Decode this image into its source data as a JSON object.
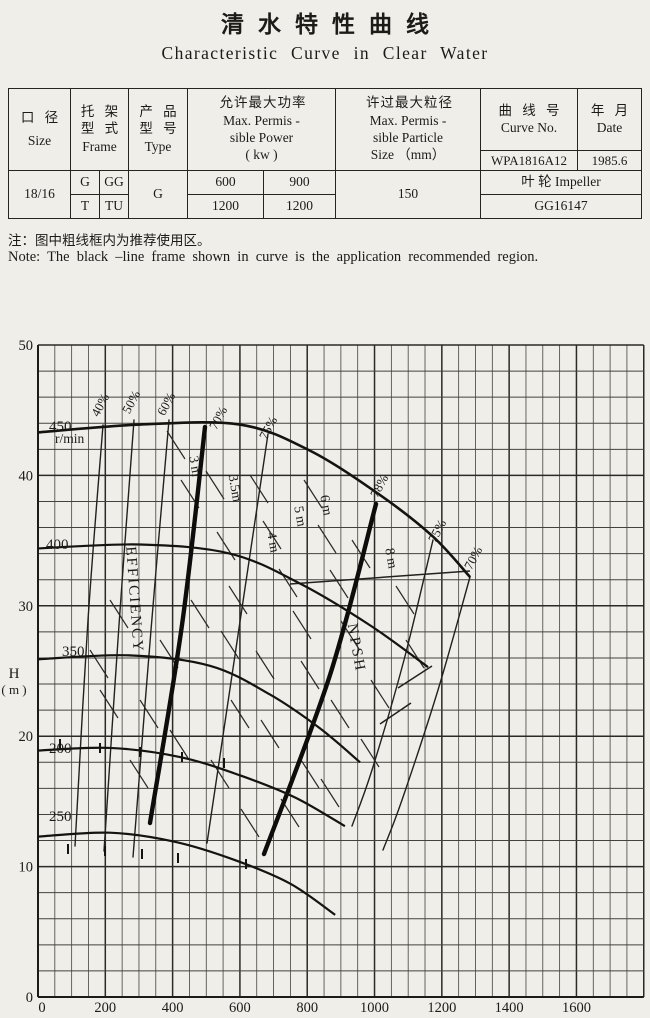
{
  "page": {
    "title_cn": "清水特性曲线",
    "title_en": "Characteristic Curve in Clear Water",
    "note_cn": "注：图中粗线框内为推荐使用区。",
    "note_en": "Note: The black –line frame shown in curve is the application recommended region."
  },
  "table": {
    "headers": {
      "size_cn": "口 径",
      "size_en": "Size",
      "frame_cn1": "托 架",
      "frame_cn2": "型 式",
      "frame_en": "Frame",
      "type_cn1": "产 品",
      "type_cn2": "型 号",
      "type_en": "Type",
      "power_cn": "允许最大功率",
      "power_en1": "Max. Permis -",
      "power_en2": "sible Power",
      "power_en3": "( kw )",
      "particle_cn": "许过最大粒径",
      "particle_en1": "Max. Permis -",
      "particle_en2": "sible Particle",
      "particle_en3": "Size （mm）",
      "curve_cn": "曲 线 号",
      "curve_en": "Curve No.",
      "date_cn": "年 月",
      "date_en": "Date"
    },
    "values": {
      "size": "18/16",
      "frame_g": "G",
      "frame_gg": "GG",
      "frame_t": "T",
      "frame_tu": "TU",
      "type": "G",
      "power_1": "600",
      "power_2": "900",
      "power_3": "1200",
      "power_4": "1200",
      "particle": "150",
      "curve_no": "WPA1816A12",
      "date": "1985.6",
      "impeller_label": "叶 轮 Impeller",
      "impeller_no": "GG16147"
    }
  },
  "chart_data": {
    "type": "line",
    "title": "Pump head vs flow characteristic curves at several speeds (r/min), with iso-efficiency and NPSH contours",
    "xlabel": "Q",
    "ylabel": "H (m)",
    "xlim": [
      0,
      1800
    ],
    "ylim": [
      0,
      50
    ],
    "x_ticks": [
      0,
      200,
      400,
      600,
      800,
      1000,
      1200,
      1400,
      1600
    ],
    "y_ticks": [
      0,
      10,
      20,
      30,
      40,
      50
    ],
    "grid": {
      "x_minor_step": 50,
      "x_major_step": 200,
      "y_step": 2,
      "y_major_step": 10,
      "on": true
    },
    "legend_position": "none",
    "series": [
      {
        "name": "450",
        "sublabel": "r/min",
        "points": [
          [
            0,
            43.3
          ],
          [
            303,
            43.9
          ],
          [
            600,
            43.9
          ],
          [
            808,
            41.9
          ],
          [
            1016,
            38.5
          ],
          [
            1174,
            35.3
          ],
          [
            1284,
            32.2
          ]
        ]
      },
      {
        "name": "400",
        "sublabel": "",
        "points": [
          [
            0,
            34.4
          ],
          [
            303,
            34.7
          ],
          [
            571,
            34.0
          ],
          [
            779,
            31.7
          ],
          [
            987,
            28.5
          ],
          [
            1159,
            25.3
          ]
        ]
      },
      {
        "name": "350",
        "sublabel": "",
        "points": [
          [
            0,
            25.9
          ],
          [
            273,
            26.2
          ],
          [
            511,
            25.4
          ],
          [
            689,
            23.2
          ],
          [
            838,
            20.6
          ],
          [
            957,
            18.0
          ]
        ]
      },
      {
        "name": "200",
        "sublabel": "",
        "points": [
          [
            0,
            18.9
          ],
          [
            214,
            19.1
          ],
          [
            422,
            18.4
          ],
          [
            600,
            17.0
          ],
          [
            764,
            15.3
          ],
          [
            912,
            13.1
          ]
        ]
      },
      {
        "name": "250",
        "sublabel": "",
        "points": [
          [
            0,
            12.3
          ],
          [
            214,
            12.6
          ],
          [
            407,
            11.9
          ],
          [
            585,
            10.5
          ],
          [
            749,
            8.7
          ],
          [
            883,
            6.3
          ]
        ]
      }
    ],
    "efficiency_contours": [
      {
        "label": "40%",
        "thick": false,
        "pts": [
          [
            103,
            425
          ],
          [
            88,
            620
          ],
          [
            75,
            846
          ]
        ],
        "label_px": [
          104,
          407
        ]
      },
      {
        "label": "50%",
        "thick": false,
        "pts": [
          [
            134,
            420
          ],
          [
            119,
            625
          ],
          [
            104,
            851
          ]
        ],
        "label_px": [
          135,
          404
        ]
      },
      {
        "label": "60%",
        "thick": false,
        "pts": [
          [
            169,
            420
          ],
          [
            151,
            630
          ],
          [
            133,
            857
          ]
        ],
        "label_px": [
          170,
          406
        ]
      },
      {
        "label": "70%",
        "thick": true,
        "pts": [
          [
            205,
            427
          ],
          [
            182,
            625
          ],
          [
            150,
            823
          ]
        ],
        "label_px": [
          222,
          420
        ]
      },
      {
        "label": "75%",
        "thick": false,
        "pts": [
          [
            268,
            434
          ],
          [
            238,
            635
          ],
          [
            207,
            843
          ]
        ],
        "label_px": [
          272,
          430
        ]
      },
      {
        "label": "78%",
        "thick": true,
        "pts": [
          [
            376,
            504
          ],
          [
            330,
            675
          ],
          [
            264,
            854
          ]
        ],
        "label_px": [
          383,
          488
        ]
      },
      {
        "label": "75%",
        "thick": false,
        "pts": [
          [
            433,
            540
          ],
          [
            404,
            660
          ],
          [
            372,
            770
          ],
          [
            352,
            826
          ]
        ],
        "label_px": [
          441,
          533
        ]
      },
      {
        "label": "70%",
        "thick": false,
        "pts": [
          [
            470,
            577
          ],
          [
            438,
            690
          ],
          [
            402,
            800
          ],
          [
            383,
            850
          ]
        ],
        "label_px": [
          477,
          560
        ]
      }
    ],
    "npsh_contours": [
      {
        "label": "3 m",
        "label_px": [
          191,
          467
        ]
      },
      {
        "label": "3.5m",
        "label_px": [
          231,
          489
        ]
      },
      {
        "label": "4 m",
        "label_px": [
          269,
          543
        ]
      },
      {
        "label": "5 m",
        "label_px": [
          296,
          517
        ]
      },
      {
        "label": "6 m",
        "label_px": [
          322,
          506
        ]
      },
      {
        "label": "8 m",
        "label_px": [
          387,
          559
        ]
      }
    ],
    "npsh_dash_centers": [
      [
        176,
        445
      ],
      [
        190,
        494
      ],
      [
        215,
        485
      ],
      [
        226,
        546
      ],
      [
        238,
        600
      ],
      [
        259,
        489
      ],
      [
        272,
        535
      ],
      [
        288,
        583
      ],
      [
        302,
        625
      ],
      [
        313,
        494
      ],
      [
        327,
        539
      ],
      [
        339,
        584
      ],
      [
        265,
        665
      ],
      [
        310,
        675
      ],
      [
        350,
        635
      ],
      [
        361,
        554
      ],
      [
        405,
        600
      ],
      [
        415,
        654
      ],
      [
        380,
        694
      ],
      [
        340,
        714
      ],
      [
        230,
        645
      ],
      [
        200,
        614
      ],
      [
        169,
        654
      ],
      [
        149,
        714
      ],
      [
        270,
        734
      ],
      [
        310,
        774
      ],
      [
        240,
        714
      ],
      [
        179,
        744
      ],
      [
        220,
        774
      ],
      [
        290,
        813
      ],
      [
        250,
        823
      ],
      [
        330,
        793
      ],
      [
        370,
        753
      ],
      [
        139,
        774
      ],
      [
        109,
        704
      ],
      [
        119,
        614
      ],
      [
        99,
        664
      ]
    ],
    "extra_lines": [
      [
        [
          290,
          584
        ],
        [
          470,
          571
        ]
      ],
      [
        [
          380,
          724
        ],
        [
          411,
          703
        ]
      ],
      [
        [
          398,
          688
        ],
        [
          432,
          666
        ]
      ]
    ],
    "curve_ticks": [
      [
        68,
        849
      ],
      [
        105,
        851
      ],
      [
        142,
        854
      ],
      [
        178,
        858
      ],
      [
        246,
        864
      ],
      [
        60,
        744
      ],
      [
        100,
        748
      ],
      [
        140,
        752
      ],
      [
        182,
        757
      ],
      [
        224,
        763
      ]
    ],
    "annotations": [
      {
        "text": "EFFICIENCY",
        "x": 130,
        "y": 600,
        "rot": 86,
        "size": 15,
        "ls": 2
      },
      {
        "text": "NPSH",
        "x": 352,
        "y": 649,
        "rot": 80,
        "size": 15,
        "ls": 3
      },
      {
        "text": "H",
        "x": 14,
        "y": 678,
        "rot": 0,
        "size": 15,
        "ls": 0
      },
      {
        "text": "( m )",
        "x": 14,
        "y": 694,
        "rot": 0,
        "size": 13,
        "ls": 0
      },
      {
        "text": "Q",
        "x": 302,
        "y": 1028,
        "rot": 0,
        "size": 15,
        "ls": 0
      }
    ],
    "layout": {
      "x0": 38,
      "y0": 997,
      "top": 345,
      "qscale": 0.33653,
      "hscale": 13.04,
      "qmax": 1800,
      "ink": "#1c1b18",
      "grid_minor": "#45423d",
      "grid_major": "#2c2a26",
      "series_label_px": [
        [
          49,
          431
        ],
        [
          46,
          549
        ],
        [
          62,
          656
        ],
        [
          49,
          753
        ],
        [
          49,
          821
        ]
      ],
      "sublabel_px": [
        55,
        443
      ],
      "eff_label_rot": -62,
      "npsh_label_rot": 80
    }
  }
}
